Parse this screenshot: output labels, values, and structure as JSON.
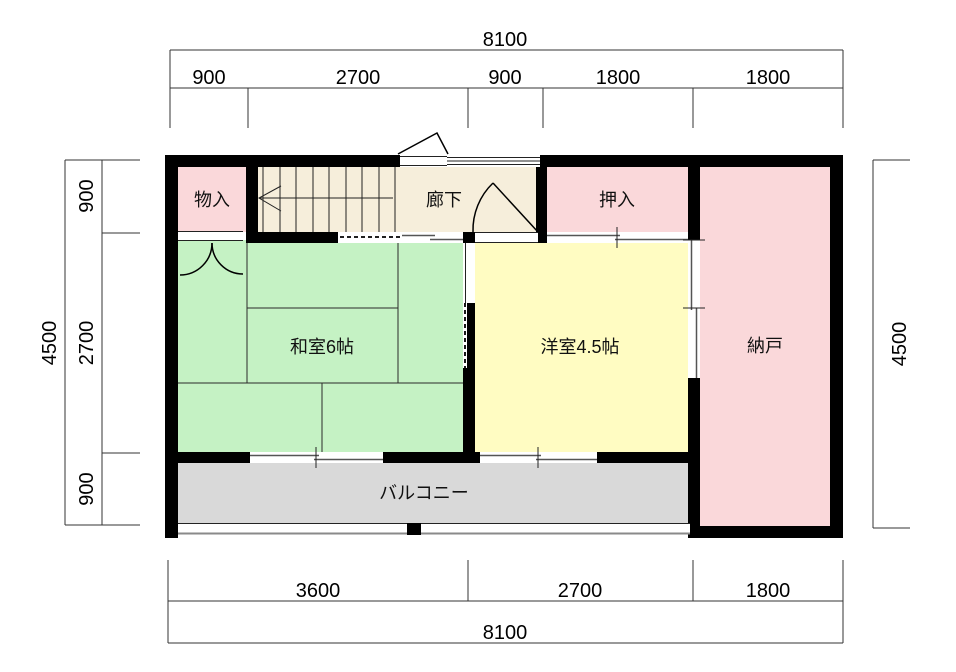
{
  "plan": {
    "rooms": {
      "monoire": "物入",
      "corridor": "廊下",
      "oshiire": "押入",
      "nando": "納戸",
      "washitsu": "和室6帖",
      "youshitsu": "洋室4.5帖",
      "balcony": "バルコニー"
    },
    "colors": {
      "storage_pink": "#fad8da",
      "tatami_green": "#c5f2c4",
      "western_yellow": "#fffcc2",
      "corridor_cream": "#f6eedb",
      "balcony_gray": "#d9d9d9",
      "wall_black": "#000000"
    }
  },
  "dimensions": {
    "top": {
      "total": "8100",
      "segments": [
        "900",
        "2700",
        "900",
        "1800",
        "1800"
      ]
    },
    "bottom": {
      "total": "8100",
      "segments": [
        "3600",
        "2700",
        "1800"
      ]
    },
    "left": {
      "total": "4500",
      "segments": [
        "900",
        "2700",
        "900"
      ]
    },
    "right": {
      "total": "4500"
    }
  }
}
